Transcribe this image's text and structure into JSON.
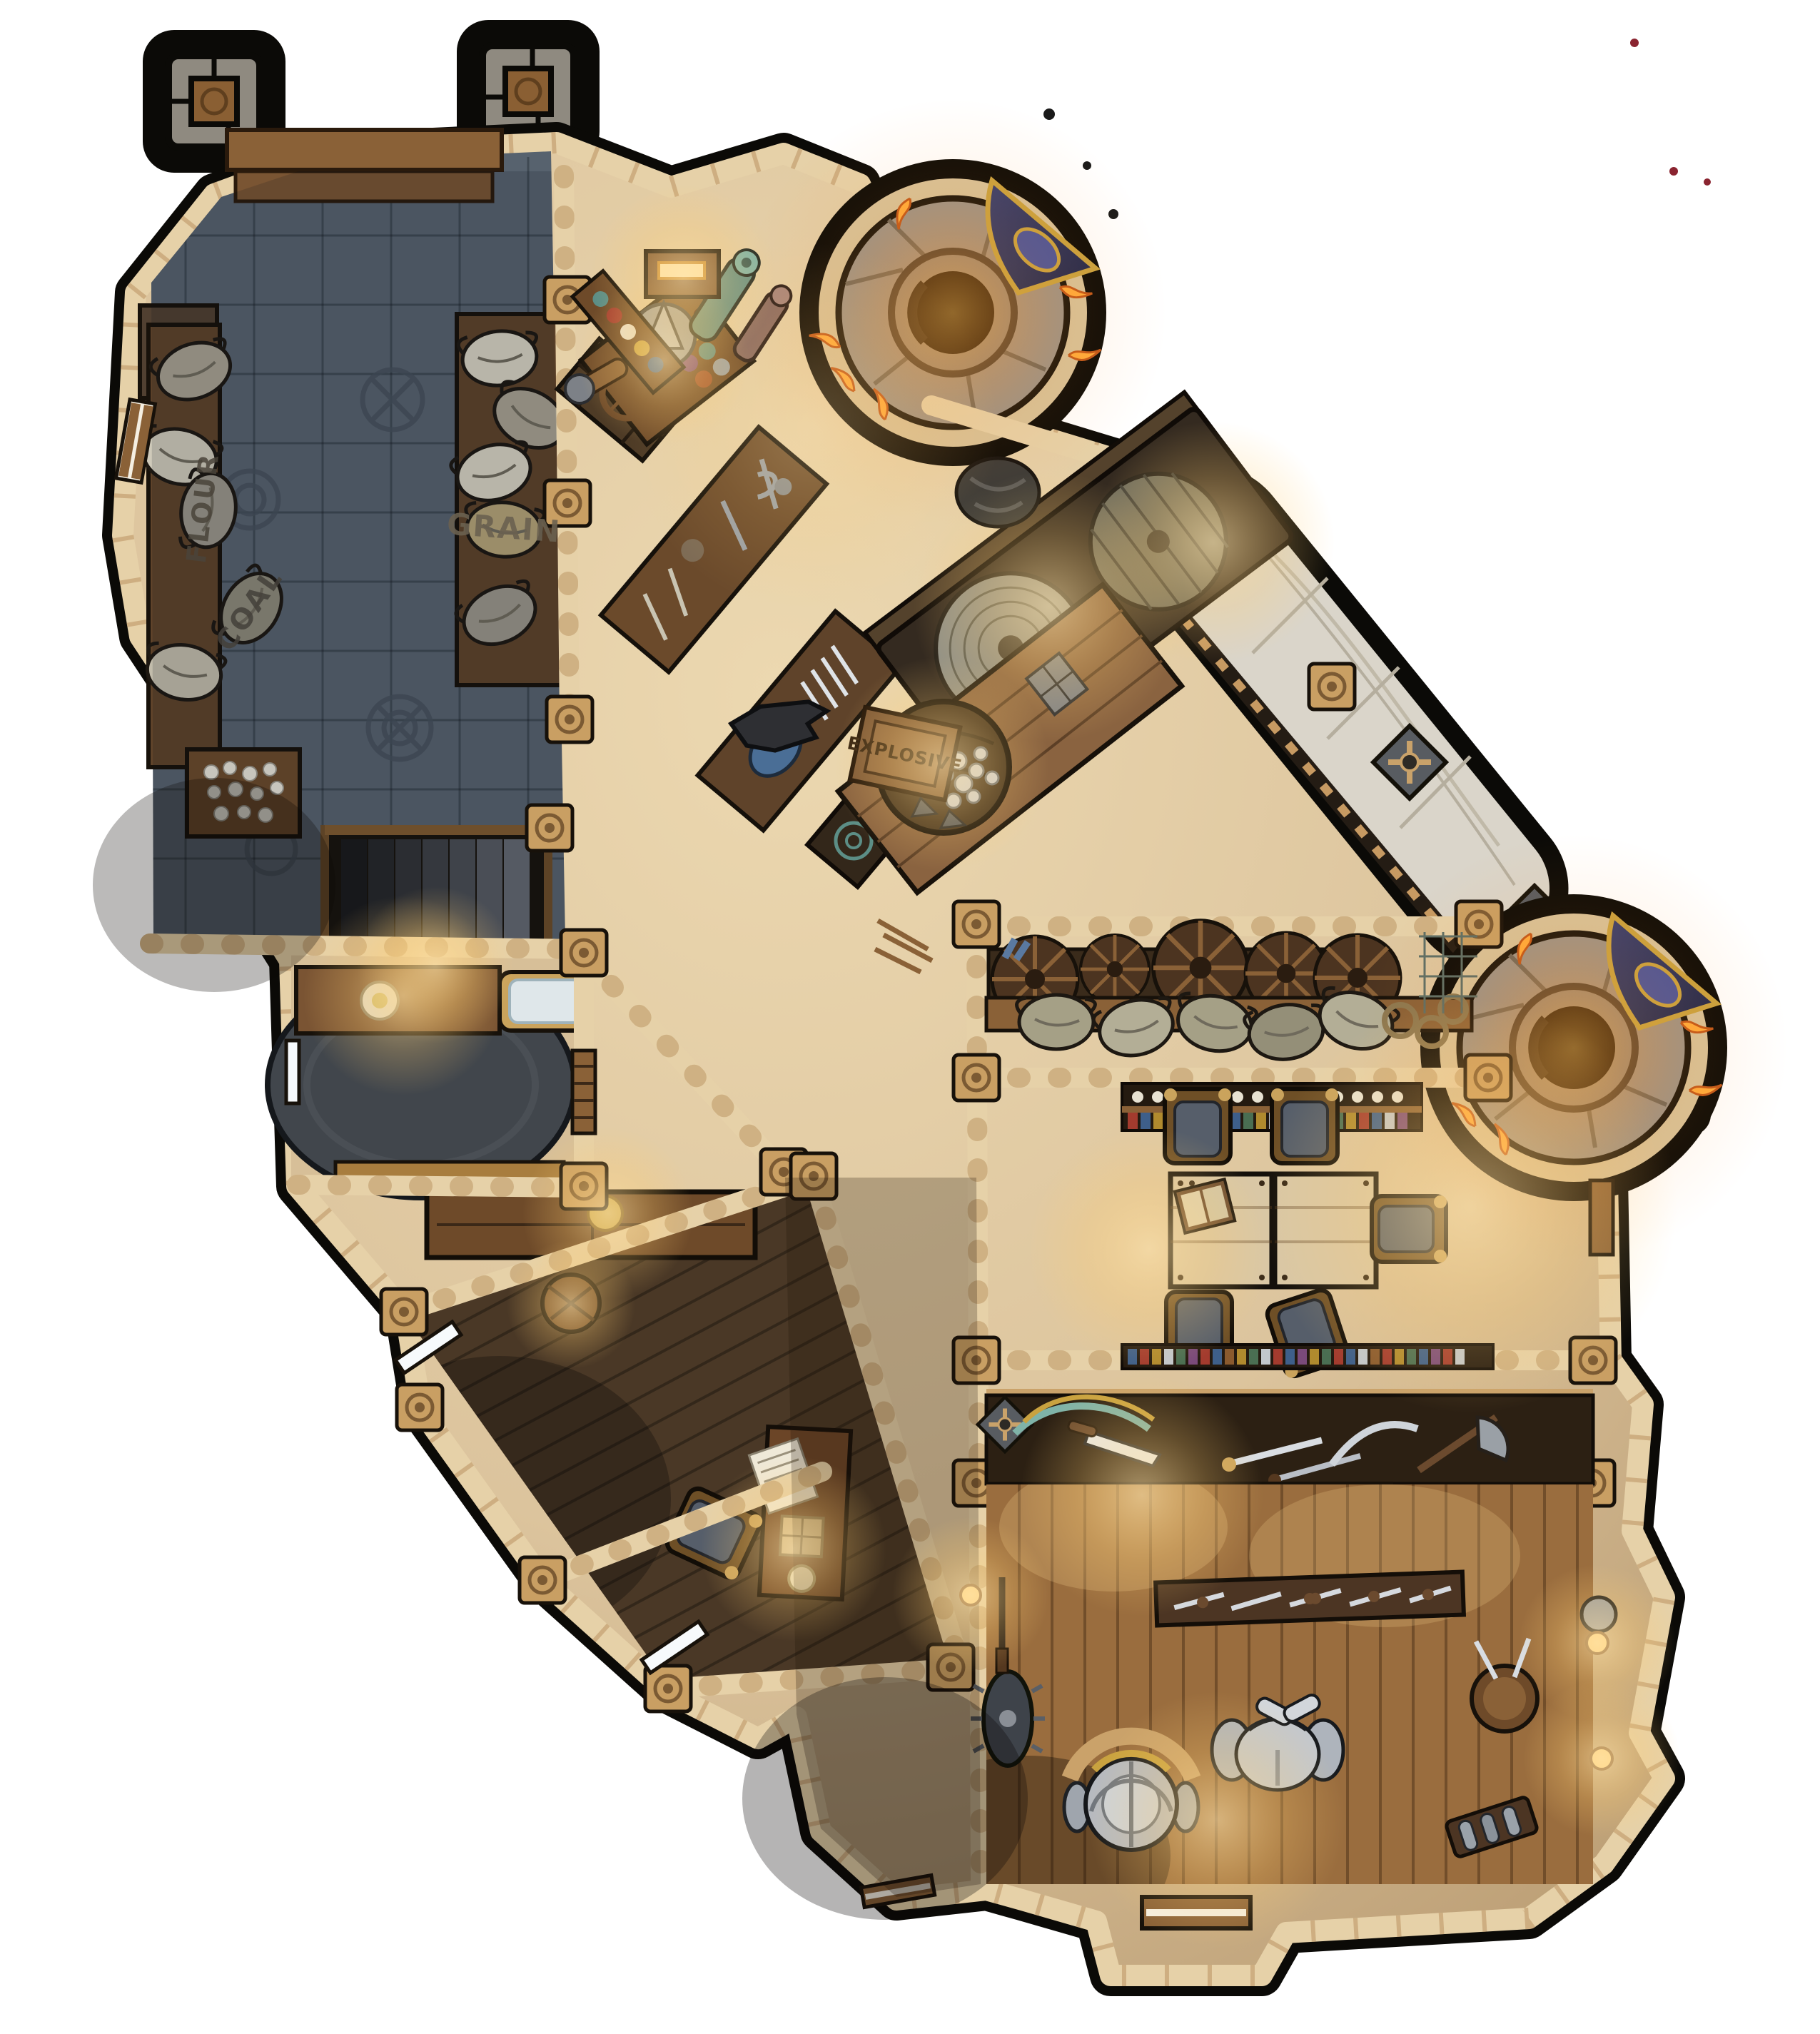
{
  "map": {
    "labels": {
      "flour": "FLOUR",
      "grain": "GRAIN",
      "coal": "COAL",
      "explosive": "EXPLOSIVE"
    },
    "palette": {
      "page_bg": "#ffffff",
      "shadow": "#0b0a07",
      "wall_sandstone": "#e6d1a8",
      "floor_tan": "#dcc49d",
      "floor_tan_dark": "#b3946a",
      "storeroom_tile": "#57626e",
      "wood_mid": "#7a5533",
      "wood_dark": "#4e3a26",
      "armory_floor": "#9a6d3e",
      "marble": "#dad5ca",
      "tower_stone": "#99938a",
      "tower_hole": "#0c0b09",
      "fire": "#ff9b2e",
      "glow": "#ffdf9e",
      "banner_blue": "#2e3560",
      "banner_gold": "#c9a23f",
      "cushion_grey": "#565e6a",
      "rug_dark": "#41464c",
      "paper": "#efe9d8"
    }
  }
}
